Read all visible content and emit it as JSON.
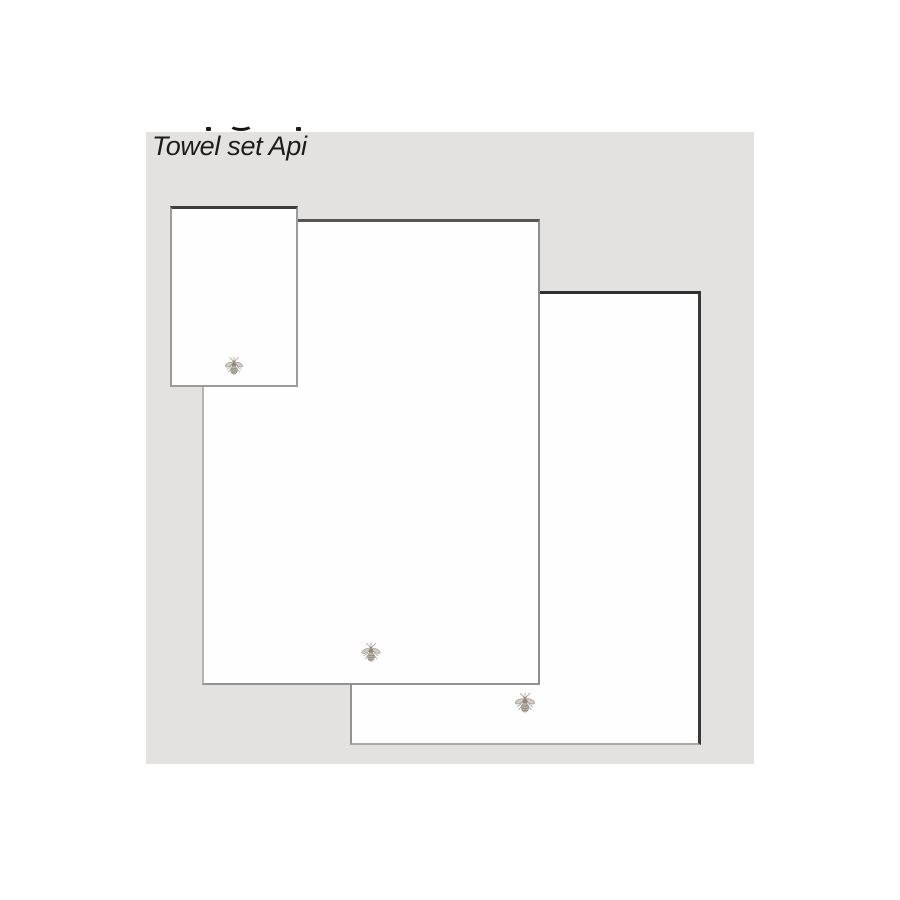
{
  "product": {
    "title": "Towel set Api",
    "image": {
      "type": "product-photo",
      "background": "#e4e2e0",
      "towels": [
        {
          "id": "small",
          "embroidery": "bee-icon"
        },
        {
          "id": "medium",
          "embroidery": "bee-icon"
        },
        {
          "id": "large",
          "embroidery": "bee-icon"
        }
      ]
    },
    "cropped_text_fragments_count": 3
  },
  "colors": {
    "page_background": "#ffffff",
    "image_background": "#e4e2e0",
    "towel_fill": "#fefefe",
    "towel_border_dark": "#3d3d3d",
    "towel_border_light": "#9a9a9a",
    "title_text": "#1c1c1c",
    "bee_embroidery": "#a59c91"
  }
}
